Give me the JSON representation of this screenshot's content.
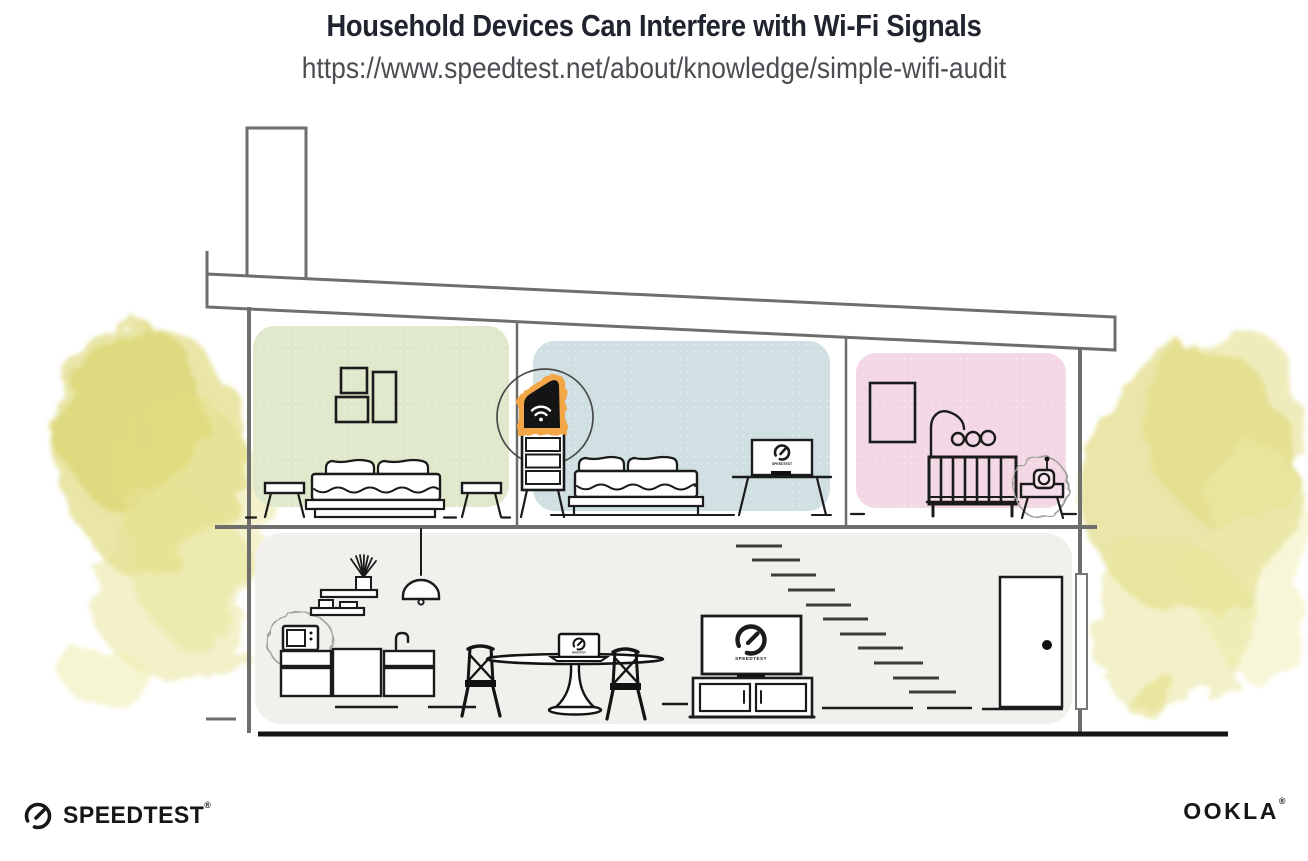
{
  "header": {
    "title": "Household Devices Can Interfere with Wi-Fi Signals",
    "url": "https://www.speedtest.net/about/knowledge/simple-wifi-audit"
  },
  "branding": {
    "speedtest_label": "SPEEDTEST",
    "speedtest_mark": "®",
    "ookla_label": "OOKLA",
    "ookla_mark": "®"
  },
  "illustration": {
    "device_screen_label": "SPEEDTEST",
    "colors": {
      "title_ink": "#20242e",
      "url_gray": "#4b4d52",
      "structure_gray": "#6e6e6b",
      "line_ink": "#1b1b1b",
      "room_green": "#dfe8cb",
      "room_blue": "#cfdfe2",
      "room_pink": "#f3d7e5",
      "lower_floor_gray": "#f1f0ec",
      "router_orange": "#f2a644",
      "foliage_yellow": "#dcd671",
      "ground_black": "#161616"
    },
    "icons": [
      "wifi-router-icon",
      "speedometer-gauge-icon",
      "microwave-icon",
      "baby-monitor-icon",
      "interference-burst-icon",
      "pendant-lamp-icon",
      "staircase"
    ]
  }
}
